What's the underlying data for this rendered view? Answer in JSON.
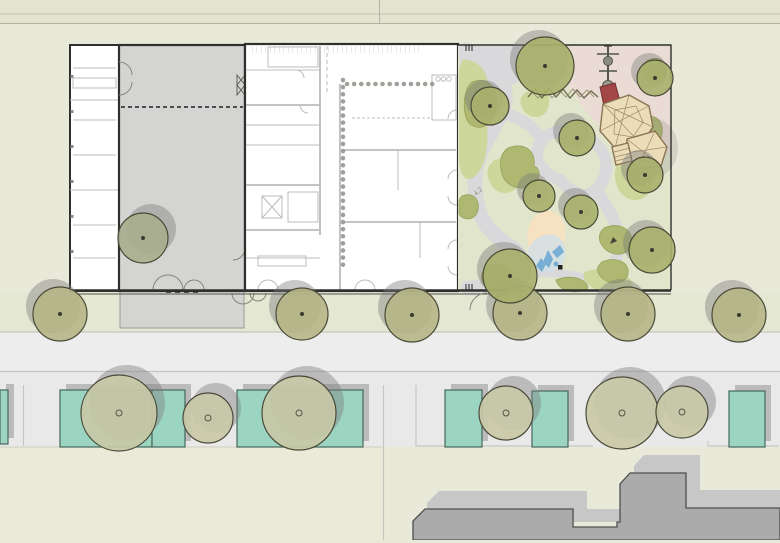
{
  "annotations": {
    "dim_label_1": "4,2"
  },
  "palette": {
    "bg": "#e9e9da",
    "bandTop": "#e3e3d0",
    "sidewalk": "#e4e7d1",
    "street": "#ededee",
    "walkLower": "#e9e9ea",
    "creamYard": "#eaead9",
    "courtyard": "#d4d4d3",
    "wallDark": "#2f2f2d",
    "innerLine": "#bcbcbc",
    "teal": "#9cd4c2",
    "tealEdge": "#46685c",
    "shadow": "rgba(125,125,125,0.42)",
    "treeStreet": "#b6b687",
    "treeYard": "#c9c9a6",
    "treeGarden": "#a9b06b",
    "courtTree": "#a8ae8e",
    "treeEdge": "#4a4a38",
    "gardenBg": "#e0e5cb",
    "pink": "#eadcd4",
    "pathGray": "#d9d9db",
    "oliveBlob": "#afb871",
    "oliveEdge": "#98a15c",
    "paleBlob": "#cdd79b",
    "sand": "#f6e2c1",
    "water": "#79aed5",
    "waterWash": "#cfdfe9",
    "playTan": "#ecddb9",
    "playEdge": "#8a7453",
    "slideRed": "#a24646",
    "bldg": "#ababab",
    "bldgShadow": "#c7c7c7",
    "bldgEdge": "#4f4f4f"
  },
  "trees": {
    "street_row": [
      {
        "x": 60,
        "y": 314,
        "r": 27
      },
      {
        "x": 302,
        "y": 314,
        "r": 26
      },
      {
        "x": 412,
        "y": 315,
        "r": 27
      },
      {
        "x": 520,
        "y": 313,
        "r": 27
      },
      {
        "x": 628,
        "y": 314,
        "r": 27
      },
      {
        "x": 739,
        "y": 315,
        "r": 27
      }
    ],
    "yard_row": [
      {
        "x": 119,
        "y": 413,
        "r": 38
      },
      {
        "x": 208,
        "y": 418,
        "r": 25
      },
      {
        "x": 299,
        "y": 413,
        "r": 37
      },
      {
        "x": 506,
        "y": 413,
        "r": 27
      },
      {
        "x": 622,
        "y": 413,
        "r": 36
      },
      {
        "x": 682,
        "y": 412,
        "r": 26
      }
    ],
    "garden": [
      {
        "x": 545,
        "y": 66,
        "r": 29
      },
      {
        "x": 655,
        "y": 78,
        "r": 18
      },
      {
        "x": 490,
        "y": 106,
        "r": 19
      },
      {
        "x": 577,
        "y": 138,
        "r": 18
      },
      {
        "x": 645,
        "y": 175,
        "r": 18
      },
      {
        "x": 539,
        "y": 196,
        "r": 16
      },
      {
        "x": 581,
        "y": 212,
        "r": 17
      },
      {
        "x": 652,
        "y": 250,
        "r": 23
      },
      {
        "x": 510,
        "y": 276,
        "r": 27
      }
    ],
    "courtyard": [
      {
        "x": 143,
        "y": 238,
        "r": 25
      }
    ]
  },
  "front_yards": [
    [
      0,
      390,
      8,
      54
    ],
    [
      60,
      390,
      92,
      57
    ],
    [
      152,
      390,
      33,
      57
    ],
    [
      237,
      390,
      126,
      57
    ],
    [
      445,
      390,
      37,
      57
    ],
    [
      532,
      391,
      36,
      56
    ],
    [
      729,
      391,
      36,
      56
    ]
  ]
}
